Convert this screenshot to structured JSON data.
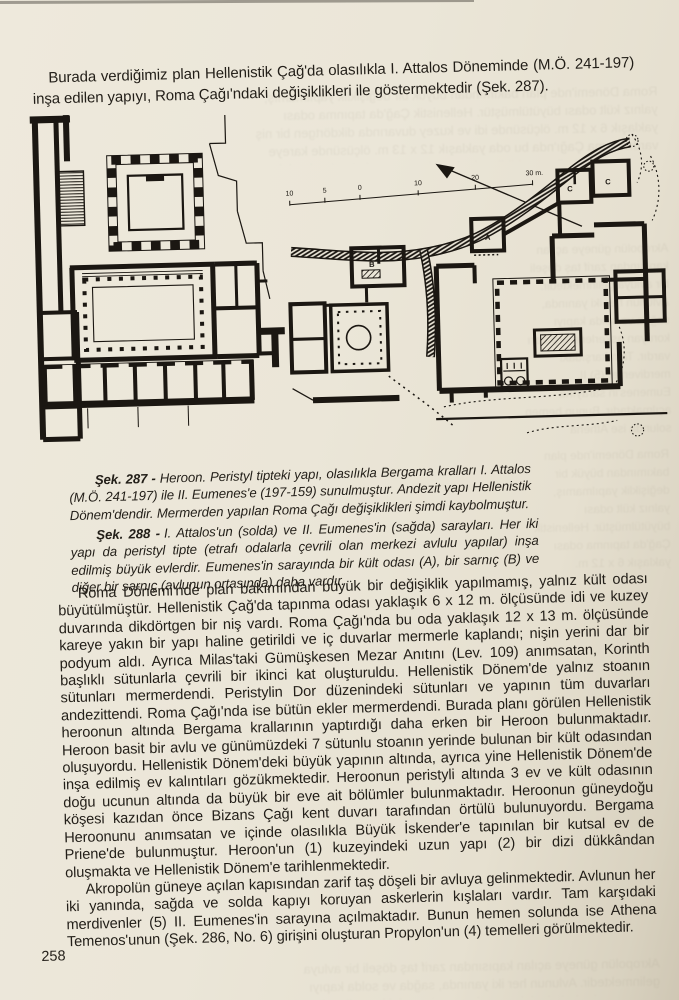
{
  "page_number": "258",
  "intro": "Burada verdiğimiz plan Hellenistik Çağ'da olasılıkla I. Attalos Döneminde (M.Ö. 241-197) inşa edilen yapıyı, Roma Çağı'ndaki değişiklikleri ile göstermektedir (Şek. 287).",
  "captions": [
    {
      "label": "Şek. 287 -",
      "text": "Heroon. Peristyl tipteki yapı, olasılıkla Bergama kralları I. Attalos (M.Ö. 241-197) ile II. Eumenes'e (197-159) sunulmuştur. Andezit yapı Hellenistik Dönem'dendir. Mermerden yapılan Roma Çağı değişiklikleri şimdi kaybolmuştur."
    },
    {
      "label": "Şek. 288 -",
      "text": "I. Attalos'un (solda) ve II. Eumenes'in (sağda) sarayları. Her iki yapı da peristyl tipte (etrafı odalarla çevrili olan merkezi avlulu yapılar) inşa edilmiş büyük evlerdir. Eumenes'in sarayında bir kült odası (A), bir sarnıç (B) ve diğer bir sarnıç (avlunun ortasında) daha vardır."
    }
  ],
  "body": {
    "p1": "Roma Dönemi'nde plan bakımından büyük bir değişiklik yapılmamış, yalnız kült odası büyütülmüştür. Hellenistik Çağ'da tapınma odası yaklaşık 6 x 12 m. ölçüsünde idi ve kuzey duvarında dikdörtgen bir niş vardı. Roma Çağı'nda bu oda yaklaşık 12 x 13 m. ölçüsünde kareye yakın bir yapı haline getirildi ve iç duvarlar mermerle kaplandı; nişin yerini dar bir podyum aldı. Ayrıca Milas'taki Gümüşkesen Mezar Anıtını (Lev. 109) anımsatan, Korinth başlıklı sütunlarla çevrili bir ikinci kat oluşturuldu. Hellenistik Dönem'de yalnız stoanın sütunları mermerdendi. Peristylin Dor düzenindeki sütunları ve yapının tüm duvarları andezittendi. Roma Çağı'nda ise bütün ekler mermerdendi. Burada planı görülen Hellenistik heroonun altında Bergama krallarının yaptırdığı daha erken bir Heroon bulunmaktadır. Heroon basit bir avlu ve günümüzdeki 7 sütunlu stoanın yerinde bulunan bir kült odasından oluşuyordu. Hellenistik Dönem'deki büyük yapının altında, ayrıca yine Hellenistik Dönem'de inşa edilmiş ev kalıntıları gözükmektedir. Heroonun peristyli altında 3 ev ve kült odasının doğu ucunun altında da büyük bir eve ait bölümler bulunmaktadır. Heroonun güneydoğu köşesi kazıdan önce Bizans Çağı kent duvarı tarafından örtülü bulunuyordu. Bergama Heroonunu anımsatan ve içinde olasılıkla Büyük İskender'e tapınılan bir kutsal ev de Priene'de bulunmuştur. Heroon'un (1) kuzeyindeki uzun yapı (2) bir dizi dükkândan oluşmakta ve Hellenistik Dönem'e tarihlenmektedir.",
    "p2": "Akropolün güneye açılan kapısından zarif taş döşeli bir avluya gelinmektedir. Avlunun her iki yanında, sağda ve solda kapıyı koruyan askerlerin kışlaları vardır. Tam karşıdaki merdivenler (5) II. Eumenes'in sarayına açılmaktadır. Bunun hemen solunda ise Athena Temenos'unun (Şek. 286, No. 6) girişini oluşturan Propylon'un (4) temelleri görülmektedir."
  },
  "figures": {
    "palaces": {
      "scale_ticks": [
        "10",
        "5",
        "0",
        "10",
        "20",
        "30 m."
      ],
      "labels": {
        "a": "A",
        "b": "B",
        "c1": "C",
        "c2": "C"
      }
    }
  },
  "colors": {
    "paper": "#eae5d7",
    "ink": "#1b1712"
  }
}
